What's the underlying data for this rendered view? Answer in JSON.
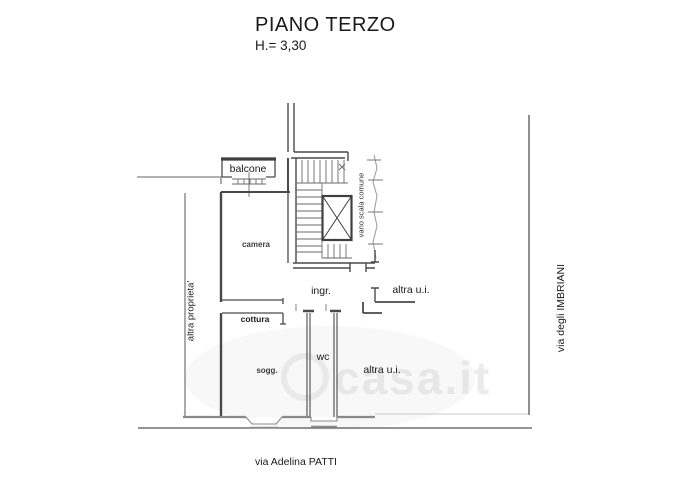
{
  "header": {
    "title": "PIANO TERZO",
    "height_note": "H.= 3,30"
  },
  "rooms": {
    "balcone": "balcone",
    "camera": "camera",
    "vano_scala": "vano scala comune",
    "ingresso": "ingr.",
    "altra_ui_top": "altra u.i.",
    "cottura": "cottura",
    "wc": "wc",
    "soggiorno": "sogg.",
    "altra_ui_bottom": "altra u.i."
  },
  "context": {
    "left_boundary": "altra proprieta'",
    "right_street": "via degli IMBRIANI",
    "bottom_street": "via Adelina PATTI"
  },
  "watermark": {
    "text": "casa.it"
  },
  "colors": {
    "wall": "#4a4a4a",
    "light_wall": "#9a9a9a",
    "boundary": "#666666",
    "label": "#1a1a1a",
    "watermark": "#d8d8d8",
    "background": "#ffffff"
  }
}
